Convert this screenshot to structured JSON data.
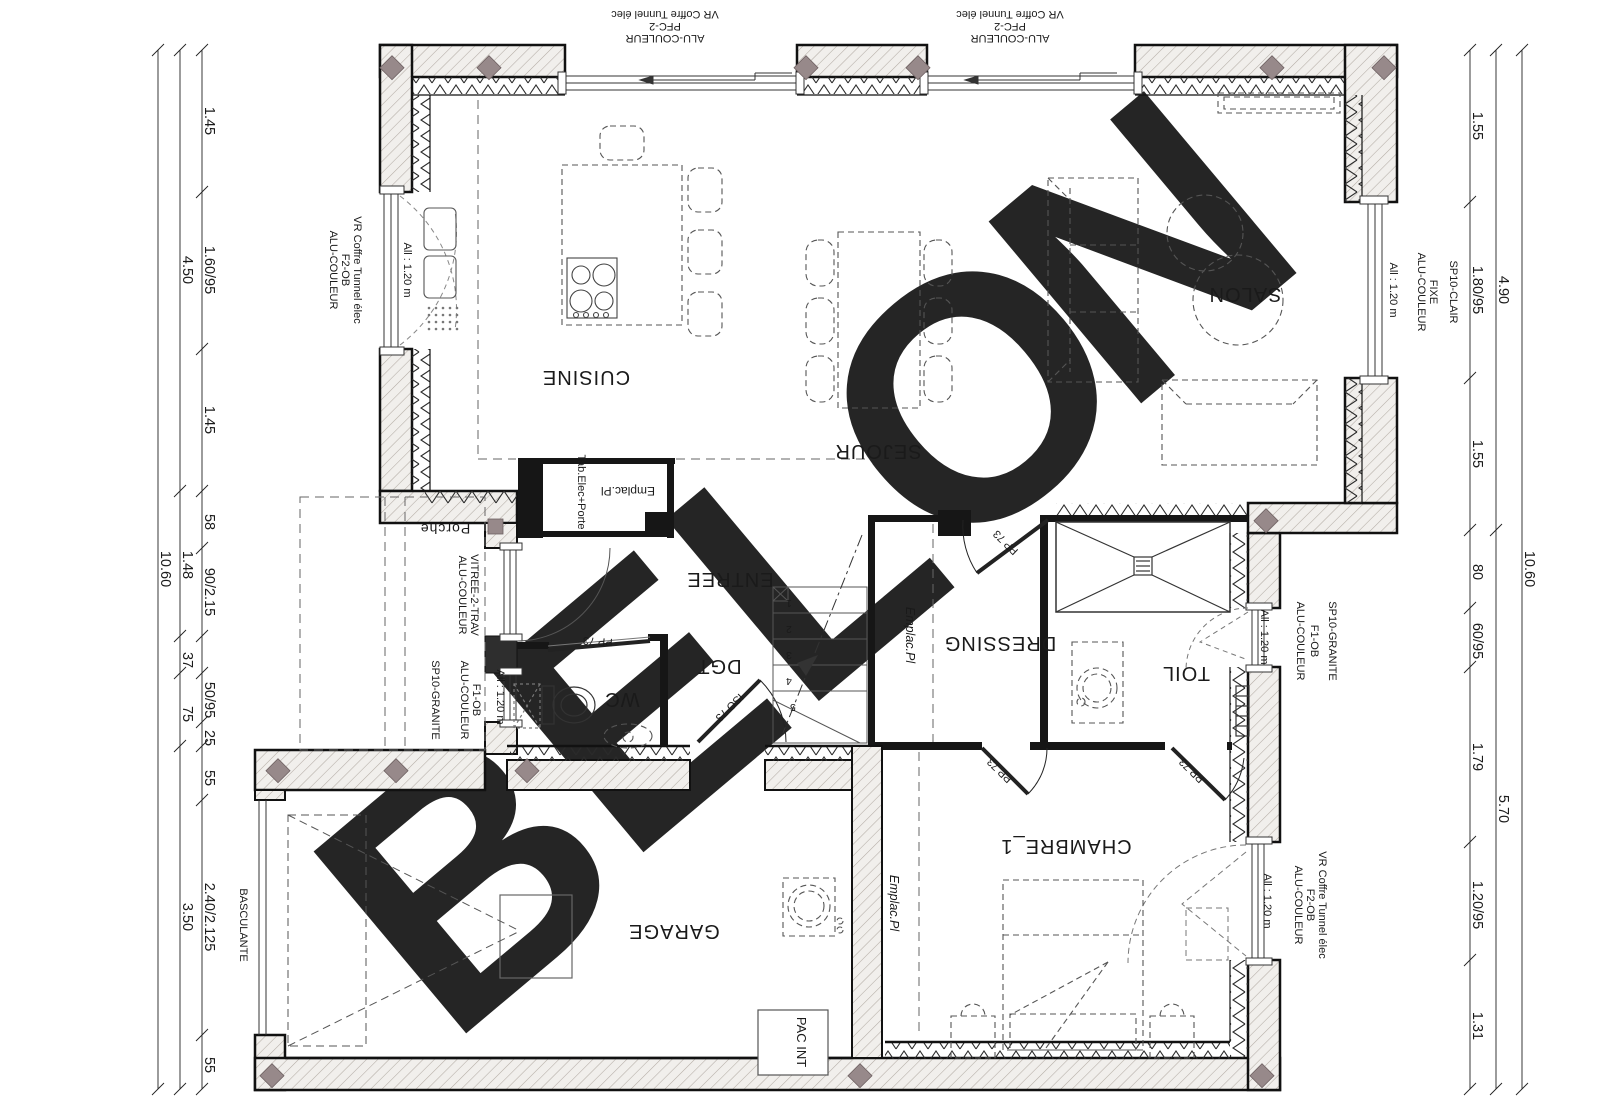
{
  "watermark": {
    "letters": [
      "B",
      "E",
      "L",
      "O",
      "N"
    ],
    "gray": "#cfcfcf",
    "yellow": "#f8e9ae"
  },
  "rooms": {
    "cuisine": "CUISINE",
    "sejour": "SEJOUR",
    "salon": "SALON",
    "entree": "ENTREE",
    "dgt": "DGT",
    "wc": "WC",
    "dressing": "DRESSING",
    "toil": "TOIL",
    "garage": "GARAGE",
    "chambre1": "CHAMBRE_1",
    "porche": "Porche"
  },
  "labels": {
    "pac_int": "PAC INT",
    "tab_elec": "Tab.Elec+Porte",
    "emplac_pl": "Emplac.Pl",
    "basculante": "BASCULANTE",
    "window_allege": "All : 1.20 m"
  },
  "doors": {
    "pp73": "PP 73",
    "iso73": "ISO 73"
  },
  "stairs": [
    "1",
    "2",
    "3",
    "4",
    "5"
  ],
  "window_notes": {
    "top": [
      "ALU-COULEUR",
      "PFC-2",
      "VR Coffre Tunnel élec"
    ],
    "left": [
      "ALU-COULEUR",
      "F2-OB",
      "VR Coffre Tunnel élec"
    ],
    "salon_east": [
      "ALU-COULEUR",
      "FIXE",
      "SP10-CLAIR"
    ],
    "toil_east": [
      "ALU-COULEUR",
      "F1-OB",
      "SP10-GRANITE"
    ],
    "chambre_east": [
      "ALU-COULEUR",
      "F2-OB",
      "VR Coffre Tunnel élec"
    ],
    "entrance": [
      "ALU-COULEUR",
      "VITREE-2-TRAV"
    ],
    "entrance_sill": "SP10-GRANITE",
    "wc": [
      "ALU-COULEUR",
      "F1-OB"
    ]
  },
  "dims": {
    "left_inner": [
      "1.45",
      "1.60/95",
      "1.45",
      "58",
      "90/2.15",
      "50/95",
      "25",
      "55",
      "2.40/2.125",
      "55"
    ],
    "left_mid": [
      "4.50",
      "1.48",
      "37",
      "75",
      "3.50"
    ],
    "left_total": "10.60",
    "right_inner": [
      "1.55",
      "1.80/95",
      "1.55",
      "80",
      "60/95",
      "1.79",
      "1.20/95",
      "1.31"
    ],
    "right_mid": [
      "4.90",
      "5.70"
    ],
    "right_total": "10.60"
  }
}
